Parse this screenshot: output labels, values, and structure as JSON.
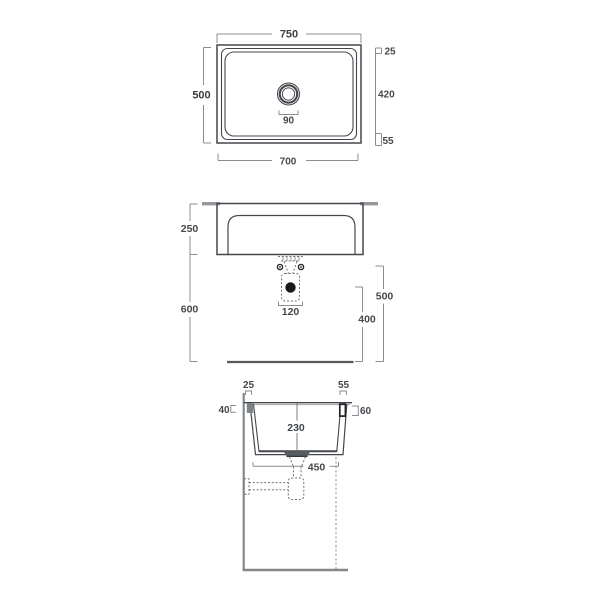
{
  "drawing": {
    "plan": {
      "overall_width": "750",
      "overall_depth": "500",
      "rim_front": "25",
      "inner_depth": "420",
      "rim_back": "55",
      "drain_hole": "90",
      "bottom_width": "700"
    },
    "elevation": {
      "basin_height": "250",
      "rim_to_floor": "600",
      "trap_width": "120",
      "outlet_height": "500",
      "trap_height": "400"
    },
    "section": {
      "front_rim": "25",
      "back_rim": "55",
      "front_lip": "40",
      "back_lip": "60",
      "bowl_depth": "230",
      "base_width": "450"
    }
  }
}
